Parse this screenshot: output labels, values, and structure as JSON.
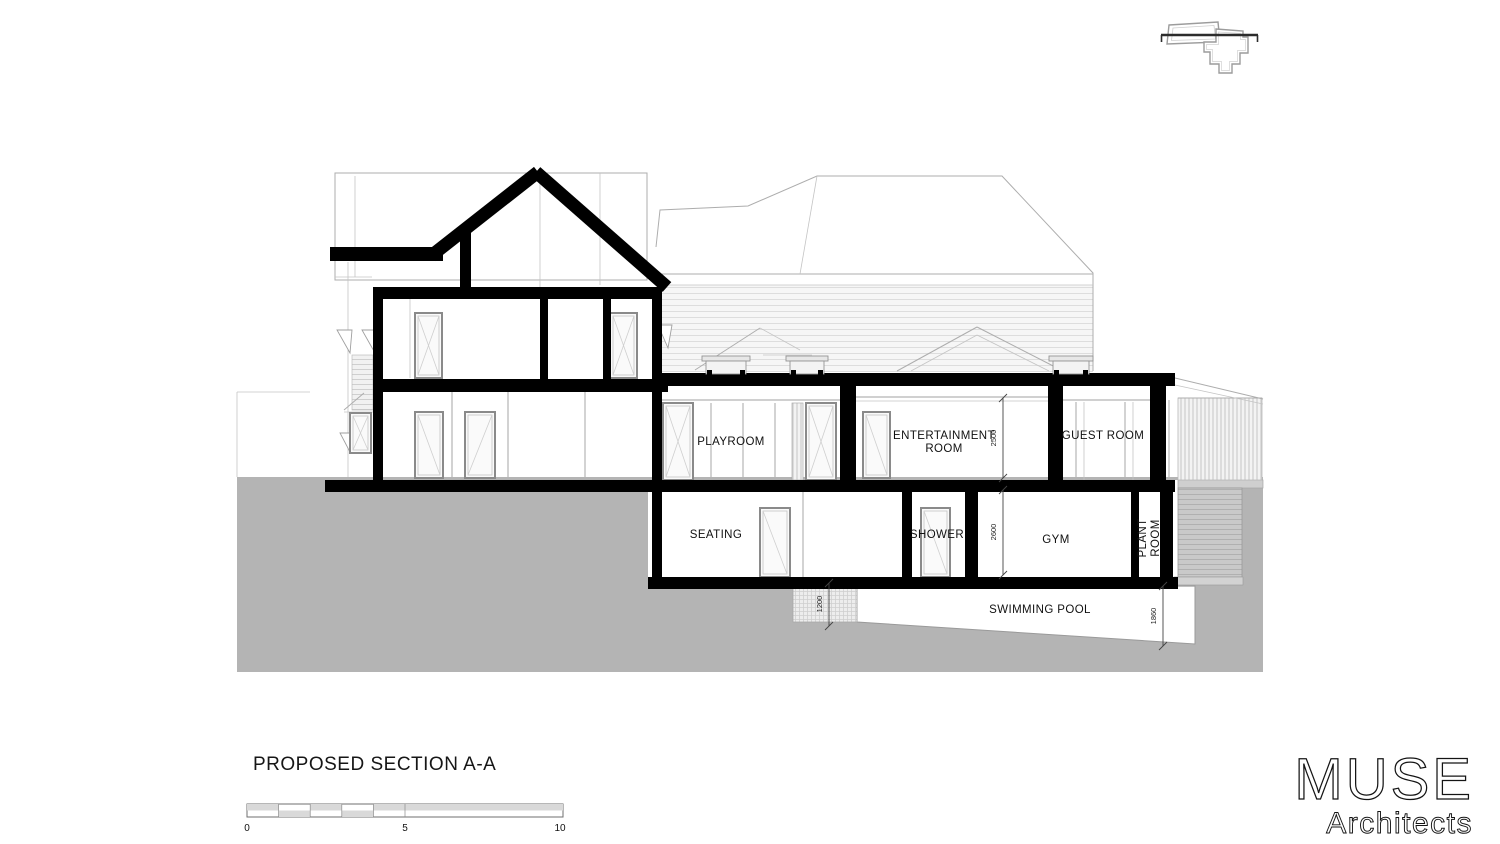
{
  "drawing": {
    "rooms": {
      "playroom": "PLAYROOM",
      "entertainment_line1": "ENTERTAINMENT",
      "entertainment_line2": "ROOM",
      "guest_room": "GUEST ROOM",
      "seating": "SEATING",
      "shower": "SHOWER",
      "gym": "GYM",
      "plant_line1": "PLANT",
      "plant_line2": "ROOM",
      "swimming_pool": "SWIMMING POOL"
    },
    "dimensions": {
      "upper_room_height": "2500",
      "lower_room_height": "2600",
      "pool_shallow_depth": "1200",
      "pool_deep_depth": "1860"
    }
  },
  "title_block": {
    "title": "PROPOSED SECTION A-A",
    "scale_ticks": {
      "start": "0",
      "mid": "5",
      "end": "10"
    }
  },
  "logo": {
    "name": "MUSE",
    "subtitle": "Architects"
  },
  "colors": {
    "ink": "#000000",
    "ground": "#b4b4b4",
    "background_line": "#adadad"
  }
}
